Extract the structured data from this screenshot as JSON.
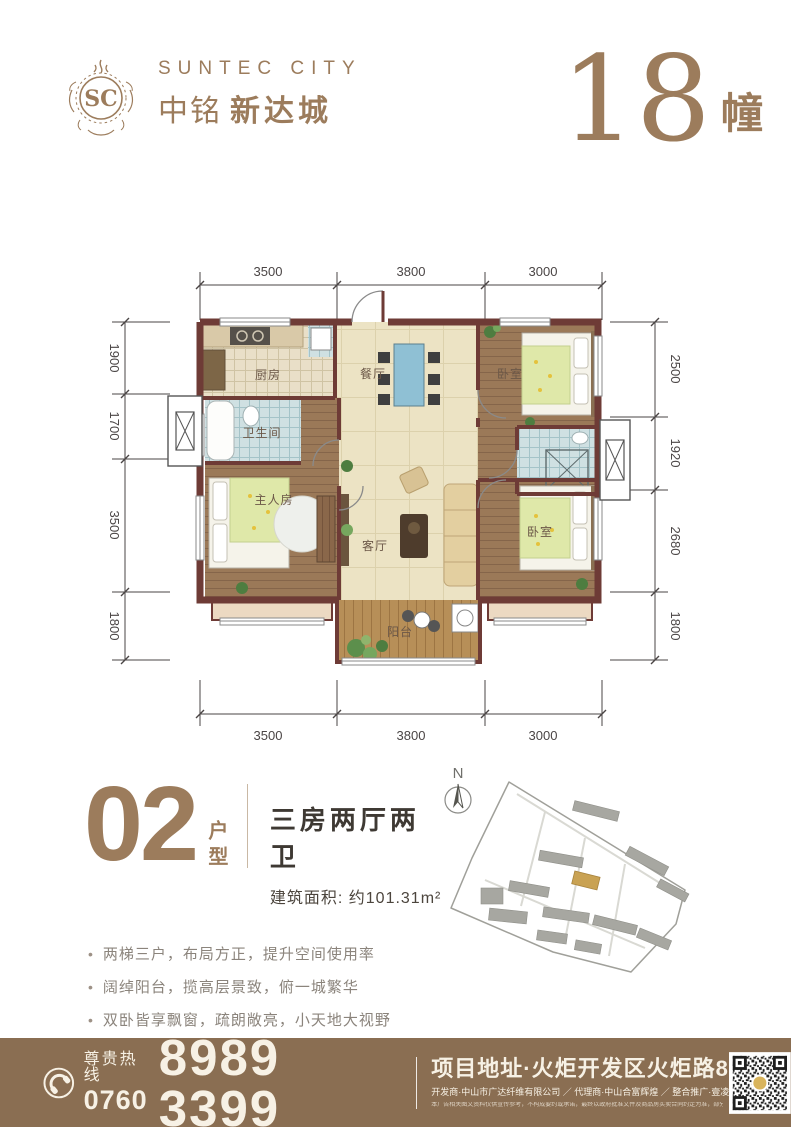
{
  "brand": {
    "monogram": "SC",
    "name_en": "SUNTEC CITY",
    "name_cn_1": "中铭",
    "name_cn_2": "新达城"
  },
  "building": {
    "number": "18",
    "unit": "幢"
  },
  "floorplan": {
    "dims_top": [
      "3500",
      "3800",
      "3000"
    ],
    "dims_bottom": [
      "3500",
      "3800",
      "3000"
    ],
    "dims_left": [
      "1900",
      "1700",
      "3500",
      "1800"
    ],
    "dims_right": [
      "2500",
      "1920",
      "2680",
      "1800"
    ],
    "rooms": {
      "kitchen": "厨房",
      "dining": "餐厅",
      "bedroom_top": "卧室",
      "bath_main": "卫生间",
      "master": "主人房",
      "living": "客厅",
      "bedroom_bottom": "卧室",
      "balcony": "阳台"
    }
  },
  "unit": {
    "number": "02",
    "suffix": "户型",
    "layout": "三房两厅两卫",
    "area_label": "建筑面积: 约101.31m²",
    "features": [
      "两梯三户，布局方正，提升空间使用率",
      "阔绰阳台，揽高层景致，俯一城繁华",
      "双卧皆享飘窗，疏朗敞亮，小天地大视野",
      "客餐厅分而不离，功能清晰，从容自在"
    ]
  },
  "siteplan": {
    "compass": "N"
  },
  "footer": {
    "hotline_label": "尊贵热线",
    "area_code": "0760",
    "phone": "8989 3399",
    "address": "项目地址·火炬开发区火炬路8号",
    "credits": "开发商·中山市广达纤维有限公司 ／ 代理商·中山合富辉煌 ／ 整合推广·壹凌壹广告",
    "disclaimer": "本广告相关图文资料仅供宣传参考，不构成要约或承诺，最终以政府批准文件及商品房买卖合同约定为准，部分图片为效果示意，开发商保留最终解释权。"
  },
  "colors": {
    "brand_brown": "#9c7c5c",
    "footer_bg": "#8a6e52",
    "wall": "#6e3b36",
    "cream_floor": "#ece3c4",
    "highlight_building": "#c9a253"
  }
}
